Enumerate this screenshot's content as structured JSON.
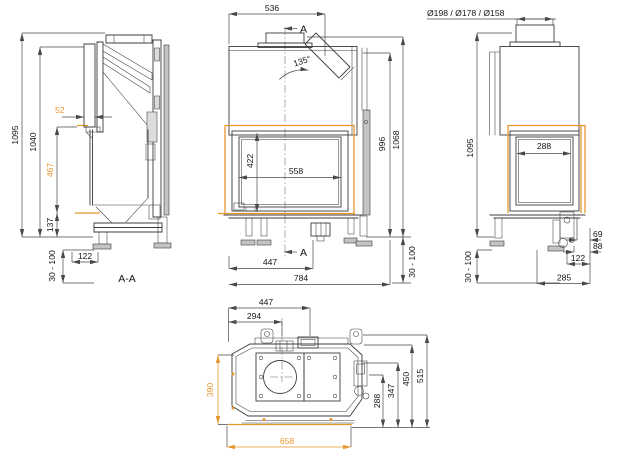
{
  "colors": {
    "accent": "#e8962e",
    "line": "#3c3c3c"
  },
  "views": {
    "side_section": {
      "label": "A-A",
      "overall_height": "1095",
      "frame_height": "1040",
      "lintel_depth": "52",
      "opening_height": "467",
      "base_height": "137",
      "foot_inset": "122",
      "foot_range": "30 - 100"
    },
    "front": {
      "section_arrow": "A",
      "top_width": "536",
      "flue_angle": "135°",
      "glass_height": "422",
      "glass_width": "558",
      "height_to_top": "996",
      "overall_height": "1068",
      "width_to_center": "447",
      "overall_width": "784",
      "foot_range": "30 - 100"
    },
    "right_side": {
      "flue_diameters": "Ø198 / Ø178 / Ø158",
      "overall_height": "1095",
      "glass_width": "288",
      "rear_offset_a": "69",
      "rear_offset_b": "88",
      "foot_inset": "122",
      "depth": "285",
      "foot_range": "30 - 100"
    },
    "top": {
      "flue_center_x": "447",
      "inlet_center_x": "294",
      "inner_depth": "390",
      "depth_to_handle": "288",
      "depth_to_mech": "347",
      "depth_to_back": "450",
      "depth_overall": "515",
      "front_width": "658"
    }
  }
}
